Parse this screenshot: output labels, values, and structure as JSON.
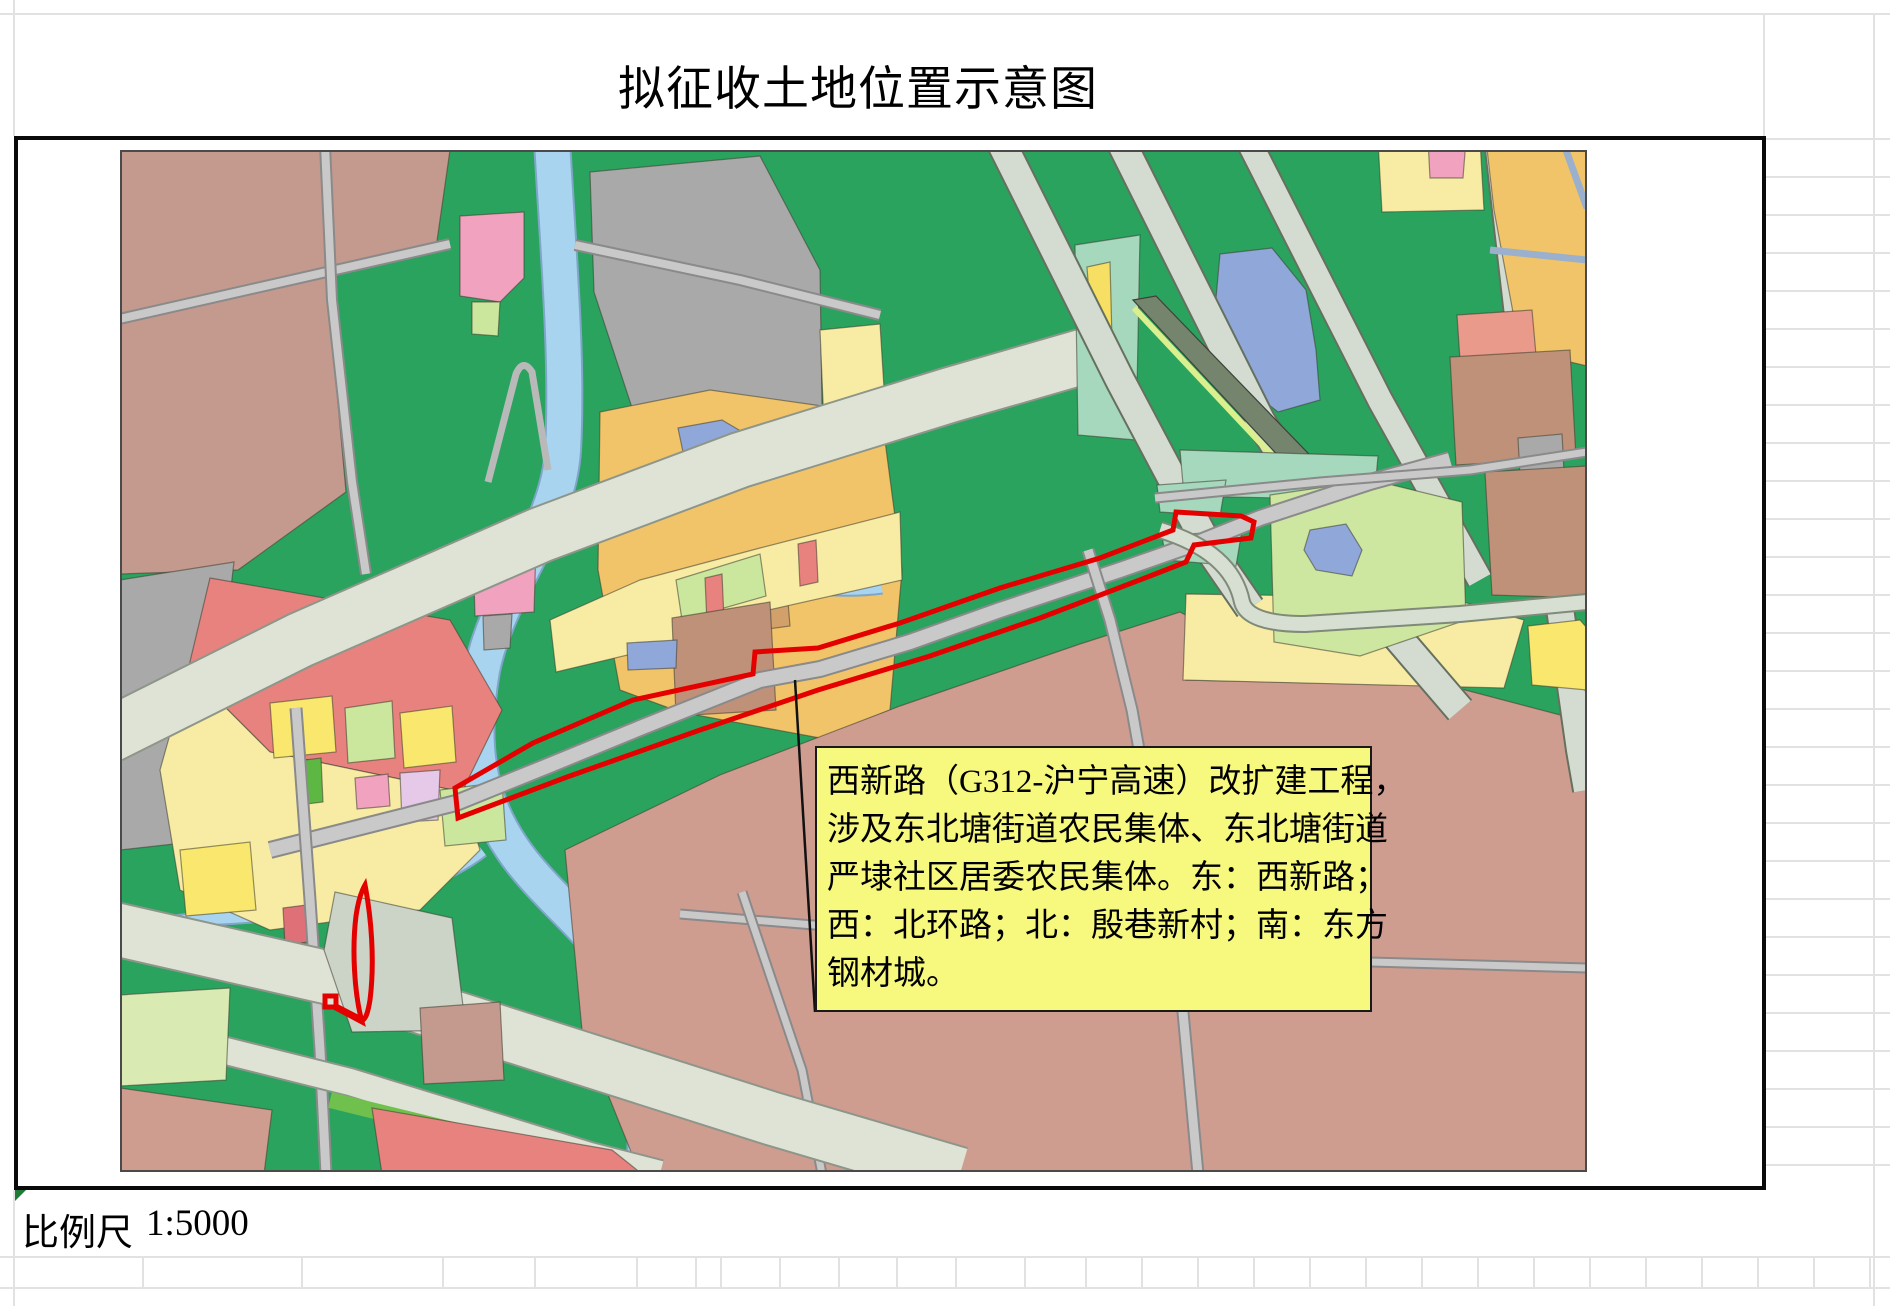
{
  "page": {
    "title": "拟征收土地位置示意图"
  },
  "scale_bar": {
    "label": "比例尺",
    "value": "1:5000"
  },
  "annotation_box": {
    "fill": "#f7f87e",
    "border_color": "#1a1a1a",
    "lines": [
      "西新路（G312-沪宁高速）改扩建工程，",
      "涉及东北塘街道农民集体、东北塘街道",
      "严埭社区居委农民集体。东：西新路；",
      "西：北环路；北：殷巷新村；南：东方",
      "钢材城。"
    ],
    "full_text": "西新路（G312-沪宁高速）改扩建工程，涉及东北塘街道农民集体、东北塘街道严埭社区居委农民集体。东：西新路；西：北环路；北：殷巷新村；南：东方钢材城。"
  },
  "spreadsheet": {
    "gridline_color": "#e2e2e2",
    "top_line_y": 14,
    "left_line_x": 14,
    "frame": {
      "x": 14,
      "y": 136,
      "w": 1752,
      "h": 1054
    },
    "right_rows": {
      "x1": 1764,
      "x2": 1890,
      "y_start": 139,
      "step": 38,
      "count": 28
    },
    "right_col_x": 1874,
    "full_lines_y": [
      1257,
      1288
    ],
    "bottom_row": {
      "y1": 1257,
      "y2": 1288,
      "boundaries": [
        143,
        302,
        443,
        535,
        637,
        696,
        721,
        780,
        839,
        897,
        956,
        1025,
        1086,
        1142,
        1198,
        1254,
        1310,
        1366,
        1422,
        1478,
        1534,
        1590,
        1646,
        1702,
        1758,
        1814,
        1870
      ]
    },
    "error_marker_color": "#1e7a34"
  },
  "map": {
    "outline_color": "#e50000",
    "palette": {
      "field_green": "#29a35d",
      "mauve": "#c49a8e",
      "dusty_rose": "#cf9d90",
      "gray_parcel": "#a9a9a9",
      "orange": "#f2c469",
      "pale_yellow": "#f8eca4",
      "bright_yellow": "#f9e76e",
      "lime": "#cbe79e",
      "pale_green": "#cde6a0",
      "teal": "#a5d8bc",
      "river": "#a9d4f0",
      "lake_blue": "#8fa8d9",
      "salmon": "#e8827e",
      "light_salmon": "#e99a8a",
      "pink": "#f0a2be",
      "lavender": "#e6c9e8",
      "brown": "#bf9178",
      "tan": "#d2a06a",
      "highway": "#dfe3d6",
      "band": "#d4dcd1",
      "road": "#c9c9c9",
      "bright_green": "#6fc04c",
      "red_parcel": "#da4f42"
    },
    "width": 1467,
    "height": 1022,
    "features": [
      {
        "name": "base-fields",
        "kind": "polygon",
        "points": "0,0 1467,0 1467,1022 0,1022",
        "fill": "#29a35d",
        "stroke": "none"
      },
      {
        "name": "mauve-parcels-topleft",
        "kind": "polygon",
        "points": "0,0 330,0 316,98 206,120 226,342 118,420 0,424",
        "fill": "#c49a8e"
      },
      {
        "name": "gray-parcel-left",
        "kind": "polygon",
        "points": "0,430 114,412 98,548 0,562",
        "fill": "#a9a9a9"
      },
      {
        "name": "gray-parcel-left-2",
        "kind": "polygon",
        "points": "0,580 96,572 90,690 0,700",
        "fill": "#a9a9a9"
      },
      {
        "name": "river",
        "kind": "water",
        "d": "M432,-10 C438,100 448,210 443,300 C438,380 378,440 362,520 C350,590 356,645 392,698 C430,755 505,800 520,868 C531,912 527,968 524,1024",
        "casing": "#7fa6c8",
        "fill": "#a9d4f0",
        "w": 34
      },
      {
        "name": "canal-west",
        "kind": "water",
        "d": "M362,700 C300,748 190,764 90,768 L-5,780",
        "casing": "#7fa6c8",
        "fill": "#a9d4f0",
        "w": 12
      },
      {
        "name": "gray-parcel-topcenter",
        "kind": "polygon",
        "points": "470,22 640,6 700,120 702,256 520,282 474,142",
        "fill": "#a9a9a9"
      },
      {
        "name": "pink-parcel-top",
        "kind": "polygon",
        "points": "340,66 404,62 404,128 380,152 340,146",
        "fill": "#f0a2be"
      },
      {
        "name": "lime-under-pink",
        "kind": "polygon",
        "points": "352,152 380,152 378,186 352,184",
        "fill": "#cbe79e"
      },
      {
        "name": "red-small-parcel",
        "kind": "polygon",
        "points": "430,378 466,374 468,390 432,394",
        "fill": "#da4f42"
      },
      {
        "name": "pink-parcel-2",
        "kind": "polygon",
        "points": "353,400 416,396 414,462 355,466",
        "fill": "#f0a2be"
      },
      {
        "name": "gray-small-parcel",
        "kind": "polygon",
        "points": "363,466 392,464 390,498 364,500",
        "fill": "#a9a9a9"
      },
      {
        "name": "orange-block-center",
        "kind": "polygon",
        "points": "480,262 590,240 702,256 762,268 782,420 770,560 700,588 560,562 500,540 478,420",
        "fill": "#f2c469"
      },
      {
        "name": "blue-pond-in-orange",
        "kind": "polygon",
        "points": "558,278 602,270 636,290 630,330 570,336",
        "fill": "#8fa8d9"
      },
      {
        "name": "canal-in-orange",
        "kind": "water",
        "d": "M556,436 C620,420 690,448 762,438",
        "casing": "#7fa6c8",
        "fill": "#a9d4f0",
        "w": 9
      },
      {
        "name": "paleyellow-wedge-top",
        "kind": "polygon",
        "points": "700,180 760,174 766,270 704,276",
        "fill": "#f8eca4"
      },
      {
        "name": "tan-rect-1",
        "kind": "polygon",
        "points": "616,426 662,420 664,444 618,450",
        "fill": "#d2a06a"
      },
      {
        "name": "tan-rect-2",
        "kind": "polygon",
        "points": "624,458 668,452 670,476 626,482",
        "fill": "#d2a06a"
      },
      {
        "name": "paleyellow-north-corridor",
        "kind": "polygon",
        "points": "430,470 520,430 640,398 780,362 782,430 640,462 520,502 436,522",
        "fill": "#f8eca4"
      },
      {
        "name": "lime-parcel-corridor",
        "kind": "polygon",
        "points": "556,430 640,404 646,446 562,470",
        "fill": "#cbe79e"
      },
      {
        "name": "salmon-sliver-1",
        "kind": "polygon",
        "points": "585,428 602,424 604,470 587,474",
        "fill": "#e8827e"
      },
      {
        "name": "salmon-sliver-2",
        "kind": "polygon",
        "points": "678,394 696,390 698,432 680,436",
        "fill": "#e8827e"
      },
      {
        "name": "brown-block-corridor",
        "kind": "polygon",
        "points": "552,468 650,452 656,560 556,566",
        "fill": "#bf9178"
      },
      {
        "name": "dusty-region-bottomright",
        "kind": "polygon",
        "points": "445,700 600,625 780,556 960,494 1060,462 1082,474 1066,530 1330,536 1467,572 1467,1024 520,1024 462,880",
        "fill": "#cf9d90"
      },
      {
        "name": "paleyellow-right-strip",
        "kind": "polygon",
        "points": "1066,444 1330,448 1404,470 1384,538 1063,530",
        "fill": "#f8eca4"
      },
      {
        "name": "salmon-block-left",
        "kind": "polygon",
        "points": "90,428 330,470 382,560 342,642 150,602 68,520",
        "fill": "#e8827e"
      },
      {
        "name": "paleyellow-zone-left",
        "kind": "polygon",
        "points": "68,520 150,602 342,642 360,700 300,760 150,780 60,740 40,620",
        "fill": "#f8eca4"
      },
      {
        "name": "yellow-parcel-1",
        "kind": "polygon",
        "points": "150,553 212,546 216,602 154,608",
        "fill": "#f9e76e"
      },
      {
        "name": "lime-parcel-1",
        "kind": "polygon",
        "points": "225,558 272,551 275,608 228,613",
        "fill": "#cbe79e"
      },
      {
        "name": "green-strip-parcel",
        "kind": "polygon",
        "points": "185,610 201,608 203,652 187,654",
        "fill": "#5db843"
      },
      {
        "name": "yellow-parcel-2",
        "kind": "polygon",
        "points": "280,563 332,556 336,612 284,618",
        "fill": "#f9e76e"
      },
      {
        "name": "pink-small-parcel",
        "kind": "polygon",
        "points": "235,628 268,624 270,656 237,659",
        "fill": "#f0a2be"
      },
      {
        "name": "lavender-parcel",
        "kind": "polygon",
        "points": "280,623 320,620 318,670 282,672",
        "fill": "#e6c9e8"
      },
      {
        "name": "lime-parcel-2",
        "kind": "polygon",
        "points": "320,640 382,632 386,690 325,696",
        "fill": "#cbe79e"
      },
      {
        "name": "yellow-parcel-3",
        "kind": "polygon",
        "points": "60,700 130,692 136,760 66,766",
        "fill": "#f9e76e"
      },
      {
        "name": "red-parcel-bottomleft",
        "kind": "polygon",
        "points": "163,758 186,755 188,792 165,795",
        "fill": "#e07078"
      },
      {
        "name": "blue-square-parcel",
        "kind": "polygon",
        "points": "507,493 557,490 556,518 508,520",
        "fill": "#8fa8d9"
      },
      {
        "name": "highway-topleft",
        "kind": "road",
        "d": "M-10,585 L180,490 L420,385 L620,310 L830,245 L1000,196",
        "casing": "#8e968a",
        "fill": "#dfe3d6",
        "w": 54
      },
      {
        "name": "hairpin-ramp",
        "kind": "line",
        "d": "M368,332 L396,224 Q403,208 412,222 L428,320",
        "stroke": "#b9b9b9",
        "w": 7
      },
      {
        "name": "teal-zone-interchange",
        "kind": "polygon",
        "points": "955,95 1020,85 1016,290 958,285",
        "fill": "#a5d8bc"
      },
      {
        "name": "yellow-blob-interchange",
        "kind": "polygon",
        "points": "967,117 990,112 992,190 972,186",
        "fill": "#f7df63"
      },
      {
        "name": "lake-topright",
        "kind": "polygon",
        "points": "1100,104 1152,98 1186,140 1196,200 1200,250 1158,262 1118,230 1094,170",
        "fill": "#8fa8d9"
      },
      {
        "name": "interchange-band-a",
        "kind": "road",
        "d": "M880,-10 L1000,230 L1090,400 L1130,458",
        "casing": "#66705f",
        "fill": "#d4dcd1",
        "w": 28
      },
      {
        "name": "interchange-band-b",
        "kind": "road",
        "d": "M1000,-10 L1140,270 L1250,455 L1340,560",
        "casing": "#66705f",
        "fill": "#d4dcd1",
        "w": 28
      },
      {
        "name": "interchange-band-c",
        "kind": "road",
        "d": "M1128,-10 L1260,250 L1360,430",
        "casing": "#66705f",
        "fill": "#d4dcd1",
        "w": 24
      },
      {
        "name": "highway-band-right",
        "kind": "road",
        "d": "M1378,-10 L1402,200 L1436,430 L1460,600 L1467,640",
        "casing": "#66705f",
        "fill": "#d4dcd1",
        "w": 26
      },
      {
        "name": "dark-sliver-structure",
        "kind": "polygon",
        "points": "1013,150 1036,146 1214,330 1192,342",
        "fill": "#75846c",
        "stroke": "#3c4238"
      },
      {
        "name": "sliver-green-strip",
        "kind": "line",
        "d": "M1014,158 L1192,348",
        "stroke": "#dcef8e",
        "w": 6
      },
      {
        "name": "teal-zone-4",
        "kind": "polygon",
        "points": "1060,300 1258,306 1254,350 1064,346",
        "fill": "#a5d8bc"
      },
      {
        "name": "palegreen-region",
        "kind": "polygon",
        "points": "1150,345 1252,330 1342,352 1346,470 1240,506 1154,492",
        "fill": "#cde6a0"
      },
      {
        "name": "palegreen-lake",
        "kind": "polygon",
        "points": "1190,380 1226,374 1242,400 1232,426 1196,420 1184,400",
        "fill": "#8fa8d9"
      },
      {
        "name": "teal-zone-1",
        "kind": "polygon",
        "points": "1037,335 1106,330 1100,366 1040,362",
        "fill": "#a5d8bc"
      },
      {
        "name": "teal-zone-2",
        "kind": "polygon",
        "points": "1042,386 1122,380 1116,416 1046,410",
        "fill": "#a5d8bc"
      },
      {
        "name": "paleyellow-topright",
        "kind": "polygon",
        "points": "1258,-10 1360,-10 1364,60 1262,62",
        "fill": "#f8eca4"
      },
      {
        "name": "pink-topright",
        "kind": "polygon",
        "points": "1308,-10 1346,-10 1343,28 1310,28",
        "fill": "#f0a2be"
      },
      {
        "name": "orange-topright",
        "kind": "polygon",
        "points": "1366,-10 1467,-10 1467,216 1400,200 1374,60",
        "fill": "#f2c469"
      },
      {
        "name": "blue-edged-road-1",
        "kind": "line",
        "d": "M1443,-8 L1467,58",
        "stroke": "#9ab0cc",
        "w": 7
      },
      {
        "name": "blue-edged-road-2",
        "kind": "line",
        "d": "M1370,100 L1467,110",
        "stroke": "#9ab0cc",
        "w": 7
      },
      {
        "name": "salmon-strip-right",
        "kind": "polygon",
        "points": "1337,165 1412,160 1416,205 1340,210",
        "fill": "#e99a8a"
      },
      {
        "name": "brown-block-right-1",
        "kind": "polygon",
        "points": "1330,207 1450,200 1456,308 1336,315",
        "fill": "#bf9178"
      },
      {
        "name": "gray-small-right",
        "kind": "polygon",
        "points": "1398,288 1442,284 1444,322 1400,326",
        "fill": "#a9a9a9"
      },
      {
        "name": "brown-block-right-2",
        "kind": "polygon",
        "points": "1365,322 1467,316 1467,448 1372,445",
        "fill": "#bf9178"
      },
      {
        "name": "yellow-patch-right",
        "kind": "polygon",
        "points": "1408,476 1460,470 1467,478 1467,540 1412,535",
        "fill": "#f9e76e"
      },
      {
        "name": "road-mauve-1",
        "kind": "road",
        "d": "M-5,170 L330,94",
        "casing": "#8a8a8a",
        "fill": "#c9c9c9",
        "w": 8
      },
      {
        "name": "road-mauve-2",
        "kind": "road",
        "d": "M205,-5 L212,150 L232,332 L246,424",
        "casing": "#8a8a8a",
        "fill": "#c9c9c9",
        "w": 8
      },
      {
        "name": "road-river-east",
        "kind": "road",
        "d": "M455,95 L620,130 L760,165",
        "casing": "#8a8a8a",
        "fill": "#c9c9c9",
        "w": 8
      },
      {
        "name": "road-corridor-main",
        "kind": "road",
        "d": "M150,700 L336,653 L430,615 L520,578 L640,530 L700,519 L790,492 L880,460 L1000,420 L1080,392 L1140,368 L1250,332 L1330,310",
        "casing": "#8a8a8a",
        "fill": "#c9c9c9",
        "w": 14
      },
      {
        "name": "road-south-descent",
        "kind": "road",
        "d": "M968,400 L990,470 L1012,560 L1035,690 L1060,830 L1078,1024",
        "casing": "#8a8a8a",
        "fill": "#c9c9c9",
        "w": 9
      },
      {
        "name": "road-curved-east",
        "kind": "road",
        "d": "M1040,380 Q1112,402 1122,452 Q1128,474 1185,474 L1340,464 L1467,452",
        "casing": "#7f8a78",
        "fill": "#d7ded2",
        "w": 14
      },
      {
        "name": "road-dusty-horizontal",
        "kind": "road",
        "d": "M560,764 L900,792 L1250,812 L1467,818",
        "casing": "#8a8a8a",
        "fill": "#c9c9c9",
        "w": 7
      },
      {
        "name": "road-dusty-vertical",
        "kind": "road",
        "d": "M622,742 L682,920 L702,1024",
        "casing": "#8a8a8a",
        "fill": "#c9c9c9",
        "w": 7
      },
      {
        "name": "road-topright-horizontal",
        "kind": "road",
        "d": "M1035,348 L1200,332 L1350,320 L1467,302",
        "casing": "#8a8a8a",
        "fill": "#c9c9c9",
        "w": 7
      },
      {
        "name": "road-vertical-bottomleft",
        "kind": "road",
        "d": "M176,558 L190,750 L200,900 L206,1024",
        "casing": "#8a8a8a",
        "fill": "#c9c9c9",
        "w": 9
      },
      {
        "name": "highway-bottomleft-a",
        "kind": "road",
        "d": "M-10,778 L210,828 L430,898 L650,968 L840,1024",
        "casing": "#8e968a",
        "fill": "#dfe3d6",
        "w": 52
      },
      {
        "name": "highway-bottomleft-b",
        "kind": "road",
        "d": "M-10,872 L230,932 L470,1006 L540,1024",
        "casing": "#8e968a",
        "fill": "#dfe3d6",
        "w": 26
      },
      {
        "name": "grayzone-bottomleft",
        "kind": "polygon",
        "points": "215,742 332,768 346,880 232,882 204,800",
        "fill": "#ccd4c8"
      },
      {
        "name": "palelime-bottomleft",
        "kind": "polygon",
        "points": "0,845 110,838 106,930 0,936",
        "fill": "#d9eab3"
      },
      {
        "name": "brightgreen-strip",
        "kind": "line",
        "d": "M210,950 L480,1016",
        "stroke": "#6fc04c",
        "w": 16
      },
      {
        "name": "salmon-bottomleft",
        "kind": "polygon",
        "points": "252,958 492,1000 522,1024 262,1024",
        "fill": "#e8827e"
      },
      {
        "name": "dusty-corner-bottomleft",
        "kind": "polygon",
        "points": "0,938 152,960 144,1024 0,1024",
        "fill": "#cf9d90"
      },
      {
        "name": "mauve-small-bottomleft",
        "kind": "polygon",
        "points": "300,858 380,852 384,930 304,934",
        "fill": "#c49a8e"
      },
      {
        "name": "acquisition-outline-sliver",
        "kind": "line",
        "d": "M245,735 C251,766 255,810 250,850 C248,862 246,868 243,870 L216,856 L216,846 L205,846 L205,857 L214,857 L242,872 C234,842 232,798 236,766 C238,752 241,742 245,735 Z",
        "stroke": "#e50000",
        "w": 5
      },
      {
        "name": "acquisition-outline-corridor",
        "kind": "line",
        "d": "M335,638 L413,593 L513,550 L633,524 L635,502 L698,498 L780,473 L880,438 L980,408 L1053,380 L1056,362 L1121,366 L1134,372 L1131,388 L1074,395 L1066,412 L1030,426 L920,468 L810,506 L698,540 L580,580 L447,627 L338,668 Z",
        "stroke": "#e50000",
        "w": 5
      },
      {
        "name": "annotation-leader-line",
        "kind": "line",
        "d": "M675,530 L695,862",
        "stroke": "#111111",
        "w": 2.5
      },
      {
        "name": "map-border",
        "kind": "polygon",
        "points": "1,1 1466,1 1466,1021 1,1021",
        "fill": "none",
        "stroke": "#4a4a4a",
        "sw": 2
      }
    ]
  }
}
